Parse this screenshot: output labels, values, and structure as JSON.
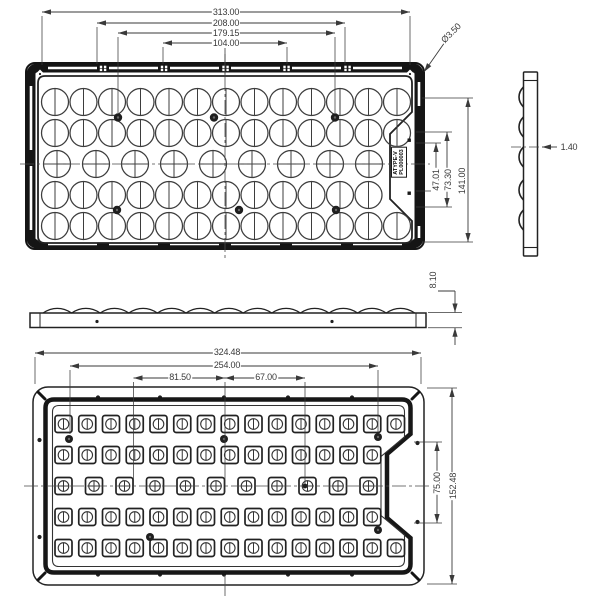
{
  "drawing": {
    "title": "LED lens array module engineering drawing",
    "colors": {
      "line": "#1a1a1a",
      "thin": "#3d3d3d",
      "dim": "#3a3a3a",
      "bg": "#ffffff"
    },
    "views": {
      "top": {
        "lens_rows": 5,
        "lens_cols": 13,
        "center_row_cols": 9,
        "notch_row_cols": 12,
        "dims": {
          "width_total": "313.00",
          "width_mid": "208.00",
          "width_holes": "179.15",
          "width_inner": "104.00",
          "corner_hole_dia": "Ø3.50",
          "height_total": "141.00",
          "height_mid": "73.30",
          "height_inner": "47.01"
        },
        "label_line1": "ATYPE-V",
        "label_line2": "PL000003"
      },
      "front": {
        "dims": {
          "height": "8.10"
        }
      },
      "side": {
        "dims": {
          "thickness": "1.40"
        }
      },
      "bottom": {
        "led_rows": 5,
        "led_cols": 15,
        "center_row_cols": 11,
        "notch_row_cols": 14,
        "dims": {
          "width_total": "324.48",
          "width_mid": "254.00",
          "width_left": "81.50",
          "width_right": "67.00",
          "height_total": "152.48",
          "height_inner": "75.00"
        }
      }
    }
  }
}
